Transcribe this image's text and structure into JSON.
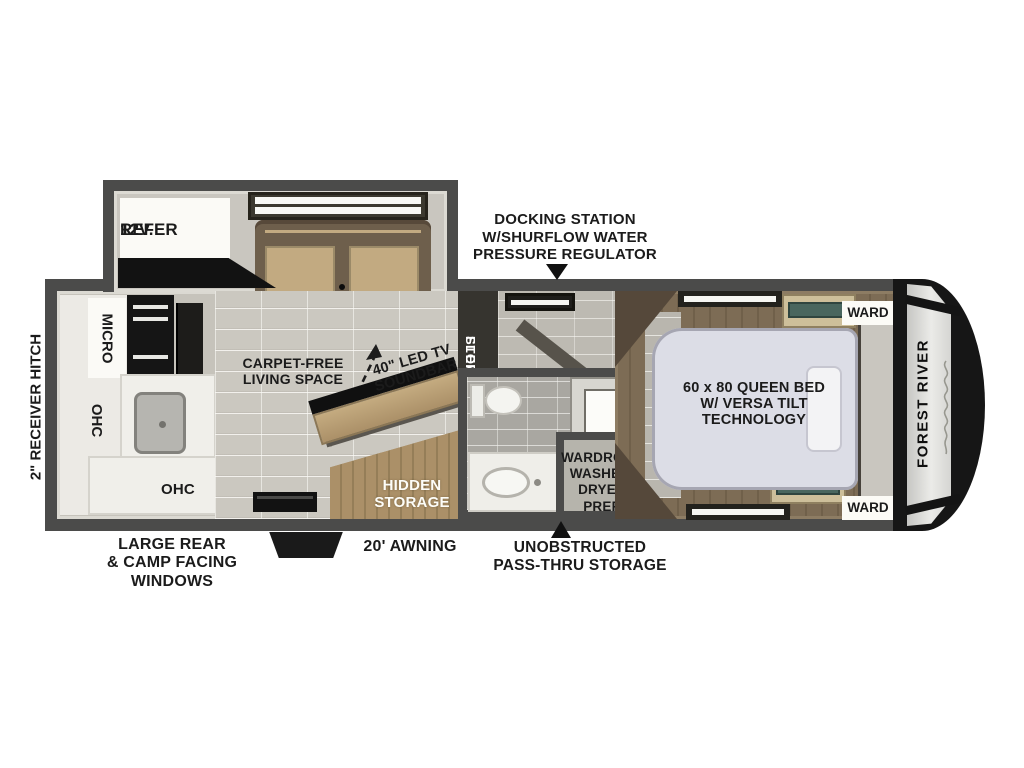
{
  "exterior": {
    "hitch": "2\" RECEIVER HITCH",
    "docking": [
      "DOCKING STATION",
      "W/SHURFLOW WATER",
      "PRESSURE REGULATOR"
    ],
    "rear_windows": [
      "LARGE REAR",
      "& CAMP FACING",
      "WINDOWS"
    ],
    "awning": "20' AWNING",
    "pass_thru": [
      "UNOBSTRUCTED",
      "PASS-THRU STORAGE"
    ],
    "brand": "FOREST RIVER"
  },
  "slide_out": {
    "refer": [
      "12V.",
      "REFER"
    ],
    "theater": "THEATER SEATING"
  },
  "kitchen": {
    "micro": "MICRO",
    "ohc_upper": "OHC",
    "ohc_lower": "OHC"
  },
  "living": {
    "carpet_free": [
      "CARPET-FREE",
      "LIVING SPACE"
    ],
    "tv": [
      "40\" LED TV",
      "SOUNDBAR"
    ],
    "hidden_storage": [
      "HIDDEN",
      "STORAGE"
    ]
  },
  "mid_section": {
    "floating_steps": [
      "FLOATING",
      "STEPS"
    ],
    "wardrobe": [
      "WARDROBE",
      "WASHER/",
      "DRYER PREP"
    ]
  },
  "bedroom": {
    "bed": [
      "60 x 80 QUEEN BED",
      "W/ VERSA TILT",
      "TECHNOLOGY"
    ],
    "ward_top": "WARD",
    "ward_bottom": "WARD"
  },
  "colors": {
    "wall": "#4b4b4a",
    "floor": "#c6c3bb",
    "tile": "#cbc8c0",
    "bedroom_wood": "#7b6a53",
    "seat_tan": "#c2aa81",
    "seat_back": "#6e5f4c",
    "bed": "#dcdde6",
    "cabinet_wood": "#ab9068",
    "label_text": "#1b1b1b",
    "cap_black": "#161616"
  }
}
